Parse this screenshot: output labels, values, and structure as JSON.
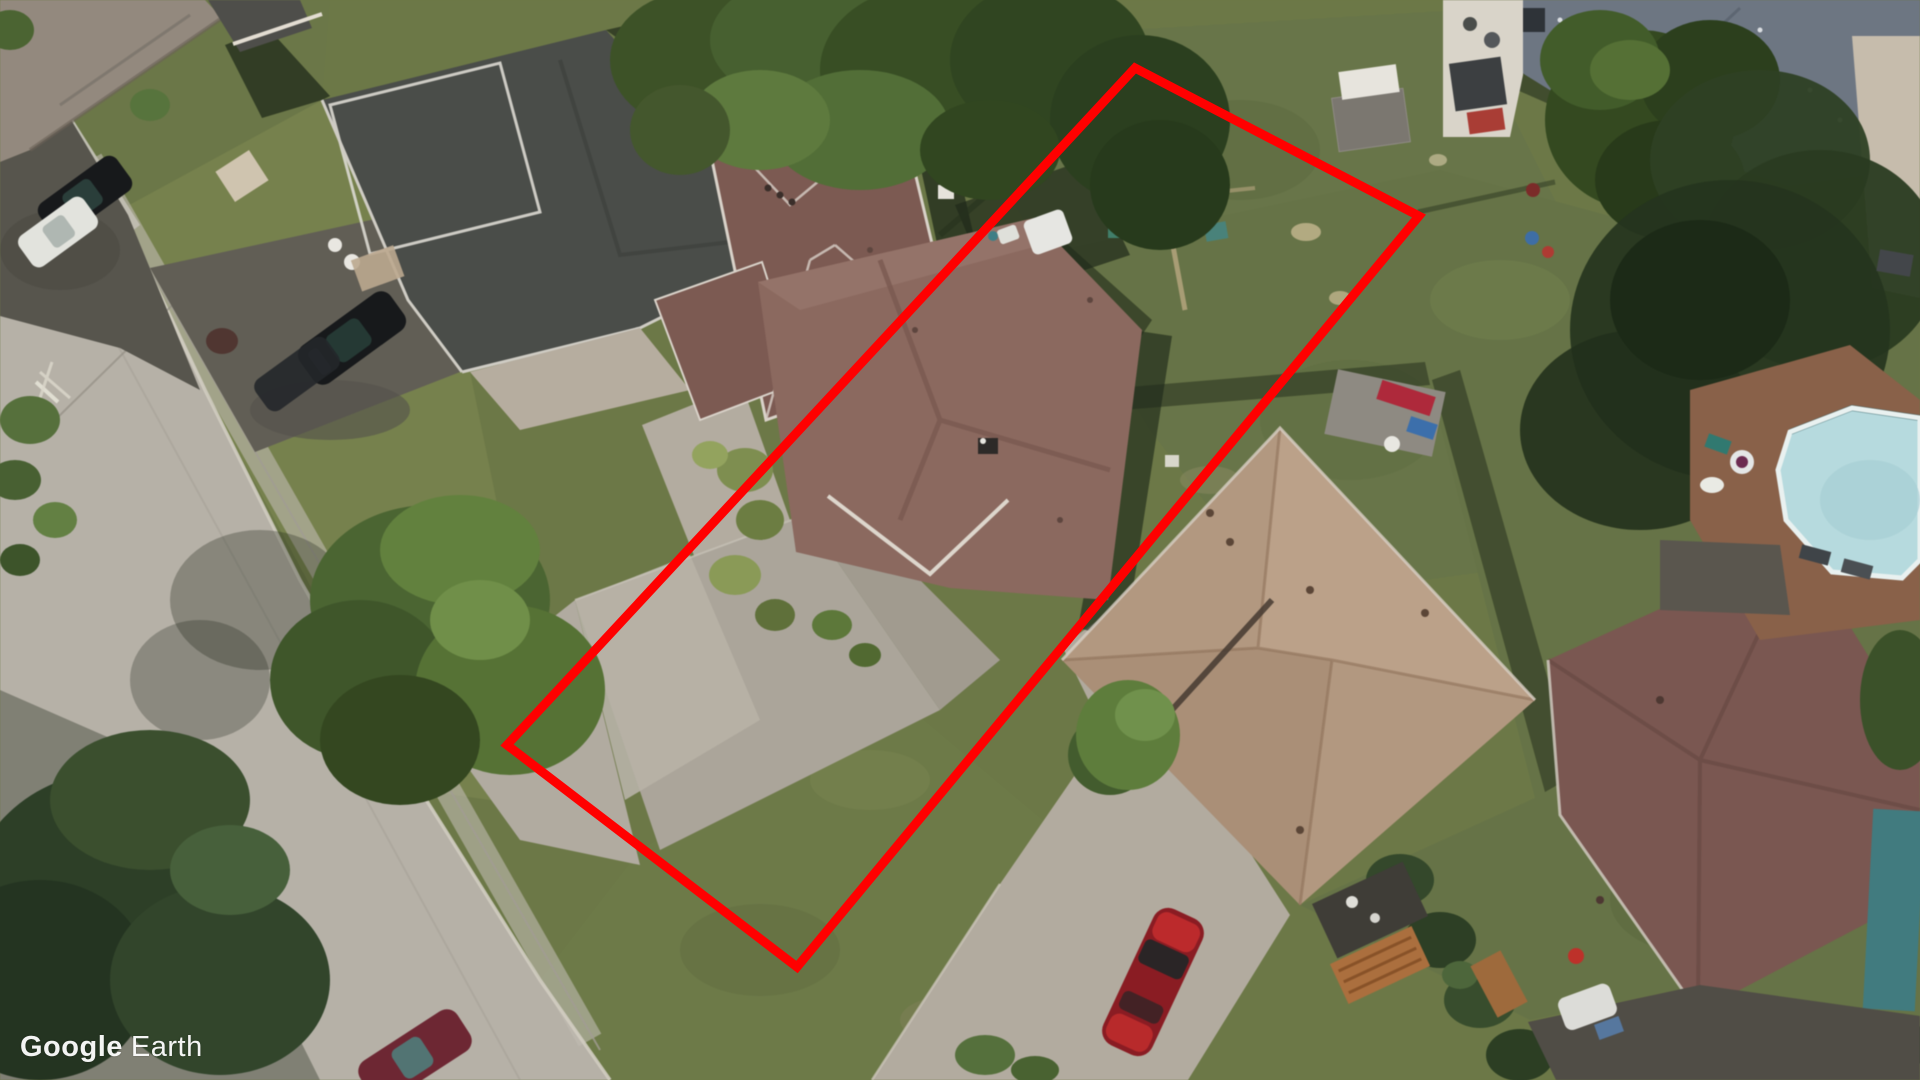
{
  "watermark": {
    "brand": "Google",
    "product": "Earth",
    "color": "#ffffff"
  },
  "annotation": {
    "type": "lot-boundary-polygon",
    "stroke": "#ff0000",
    "stroke_width": "9",
    "fill": "none",
    "points": "1135,68 1419,216 797,967 507,745"
  },
  "palette": {
    "lawn": "#6c7845",
    "lawn_front": "#76814b",
    "lawn_back": "#687547",
    "road": "#b6b1a7",
    "road_light": "#c8c4ba",
    "curb": "#d2cdc1",
    "asphalt_dark": "#57554d",
    "drive_dark": "#615e55",
    "concrete": "#aba59a",
    "concrete_light": "#b8b2a6",
    "roof_gray": "#93897d",
    "roof_charcoal": "#4a4d49",
    "roof_brown_small": "#7d5a51",
    "roof_subject": "#8c695e",
    "roof_tan": "#b3987f",
    "roof_maroon": "#7b5750",
    "roof_slate": "#6d7683",
    "pool_water": "#b5dade",
    "pool_rim": "#e9f1f0",
    "deck_wood": "#8a6148",
    "tree_dark": "#2c3f26",
    "tree_mid": "#4a6530",
    "tree_light": "#61813c",
    "car_black": "#17191b",
    "car_white": "#e2e3dd",
    "car_red": "#8e1b22",
    "car_red_bright": "#c62b2c",
    "car_maroon": "#6f2633",
    "shadow": "#1f2a19"
  }
}
